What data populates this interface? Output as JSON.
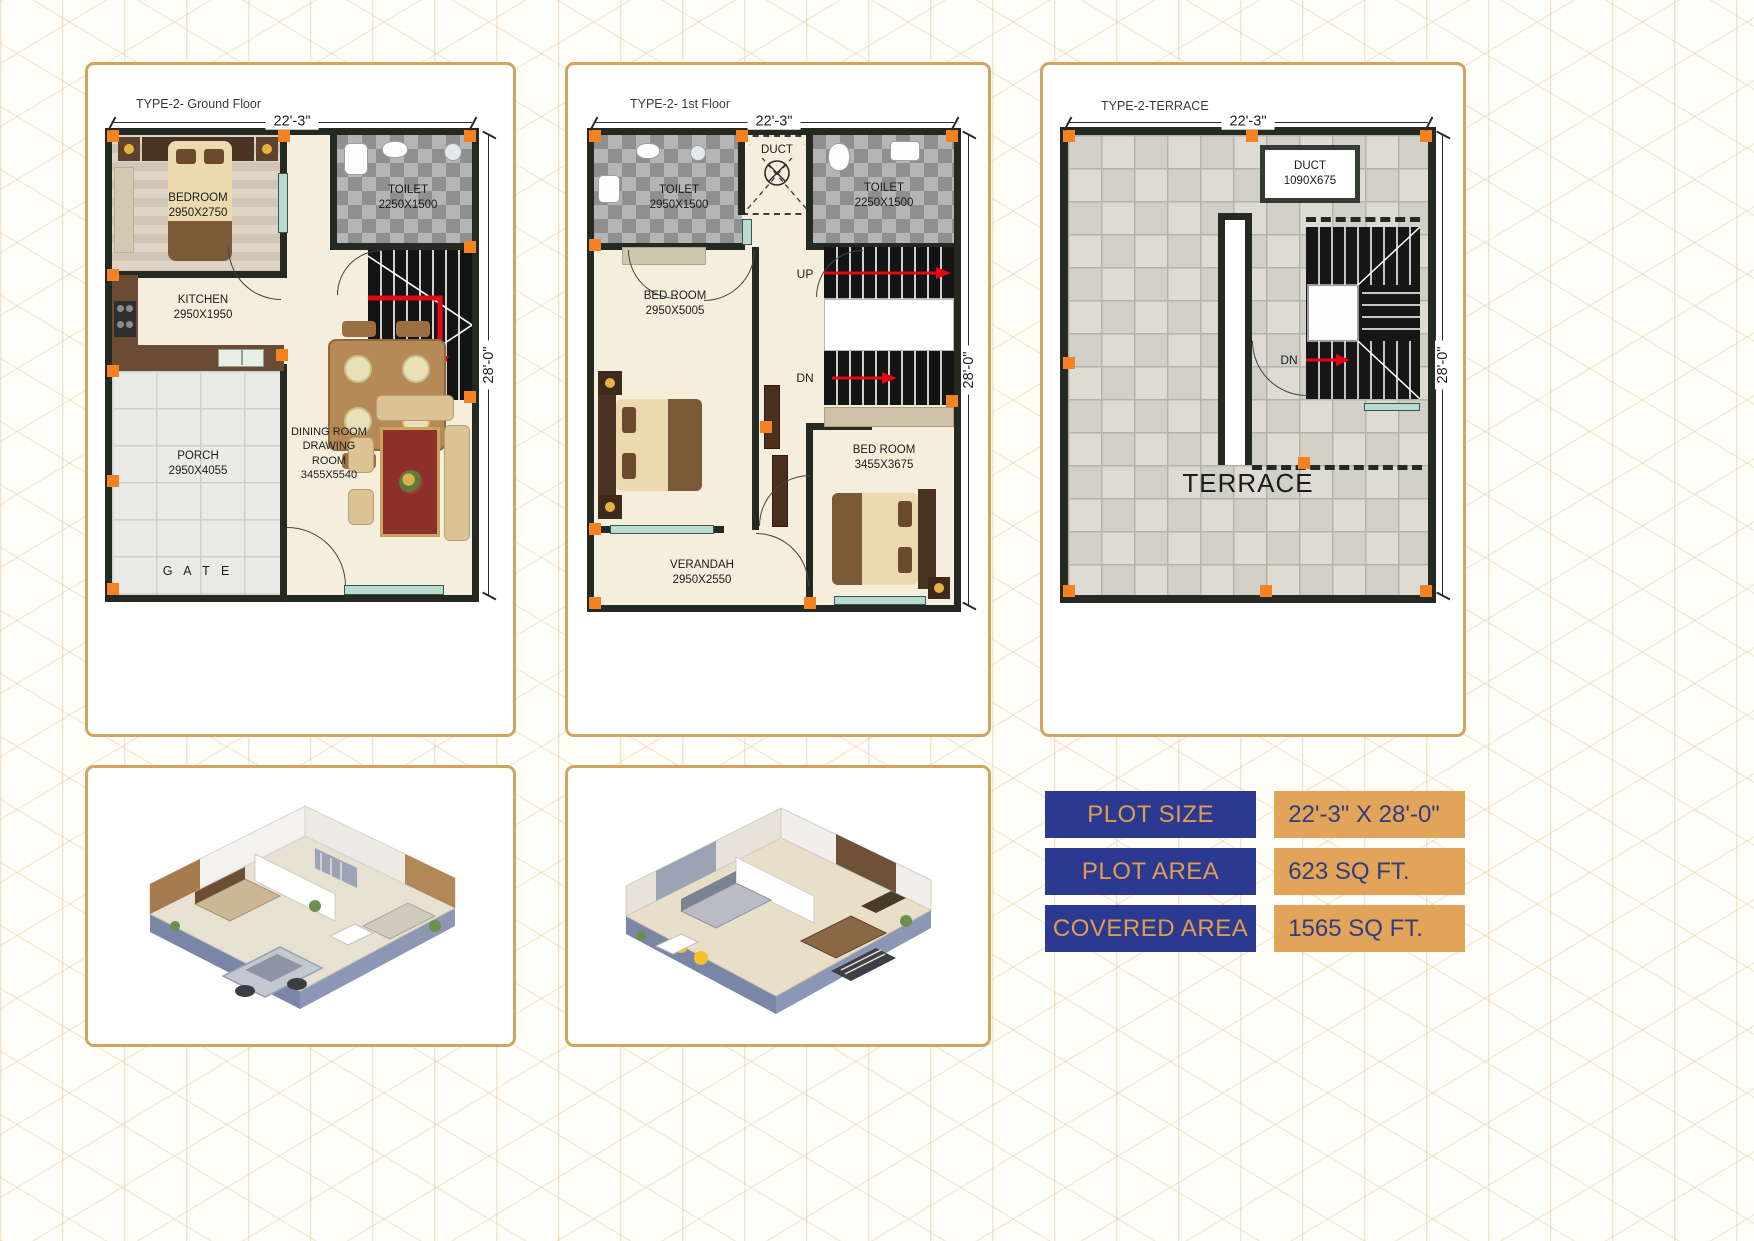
{
  "colors": {
    "card_border": "#d1a55f",
    "wall": "#242a21",
    "marker_orange": "#f58220",
    "navy": "#2b3990",
    "orange": "#e1a458",
    "red_arrow": "#e30613",
    "window_teal": "#b9dcce"
  },
  "plans": {
    "ground": {
      "title": "TYPE-2- Ground Floor",
      "width_dim": "22'-3\"",
      "height_dim": "28'-0\"",
      "bedroom": {
        "name": "BEDROOM",
        "size": "2950X2750"
      },
      "toilet": {
        "name": "TOILET",
        "size": "2250X1500"
      },
      "kitchen": {
        "name": "KITCHEN",
        "size": "2950X1950"
      },
      "porch": {
        "name": "PORCH",
        "size": "2950X4055"
      },
      "dining": {
        "line1": "DINING ROOM",
        "line2": "DRAWING",
        "line3": "ROOM",
        "size": "3455X5540"
      },
      "gate": "G A T E"
    },
    "first": {
      "title": "TYPE-2- 1st Floor",
      "width_dim": "22'-3\"",
      "height_dim": "28'-0\"",
      "toilet_left": {
        "name": "TOILET",
        "size": "2950X1500"
      },
      "duct": {
        "name": "DUCT"
      },
      "toilet_right": {
        "name": "TOILET",
        "size": "2250X1500"
      },
      "bedroom_left": {
        "name": "BED ROOM",
        "size": "2950X5005"
      },
      "bedroom_right": {
        "name": "BED ROOM",
        "size": "3455X3675"
      },
      "verandah": {
        "name": "VERANDAH",
        "size": "2950X2550"
      },
      "up": "UP",
      "dn": "DN"
    },
    "terrace": {
      "title": "TYPE-2-TERRACE",
      "width_dim": "22'-3\"",
      "height_dim": "28'-0\"",
      "duct": {
        "name": "DUCT",
        "size": "1090X675"
      },
      "label": "TERRACE",
      "dn": "DN"
    }
  },
  "specs": {
    "rows": [
      {
        "label": "PLOT SIZE",
        "value": "22'-3\" X 28'-0\""
      },
      {
        "label": "PLOT AREA",
        "value": "623 SQ FT."
      },
      {
        "label": "COVERED AREA",
        "value": "1565 SQ FT."
      }
    ]
  }
}
